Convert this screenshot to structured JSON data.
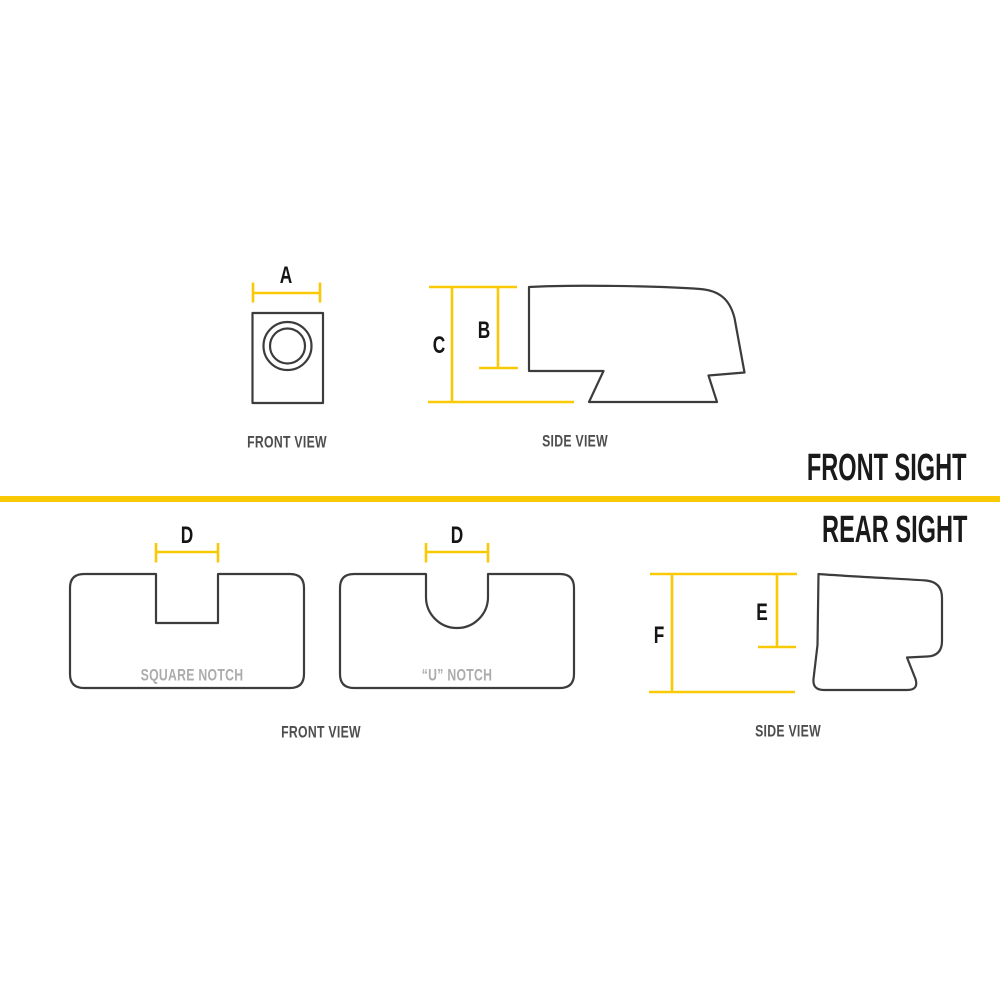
{
  "colors": {
    "accent_yellow": "#F9C906",
    "outline": "#3C3C3C",
    "title_text": "#1A1A1A",
    "caption_text": "#4D4D4D",
    "muted_label": "#ACACAC",
    "background": "#FFFFFF"
  },
  "front_sight": {
    "section_title": "FRONT SIGHT",
    "front_view": {
      "caption": "FRONT VIEW",
      "width_dim_label": "A"
    },
    "side_view": {
      "caption": "SIDE VIEW",
      "blade_height_dim_label": "B",
      "overall_height_dim_label": "C"
    }
  },
  "rear_sight": {
    "section_title": "REAR SIGHT",
    "front_view": {
      "caption": "FRONT VIEW",
      "square_notch_label": "SQUARE NOTCH",
      "square_notch_width_dim_label": "D",
      "u_notch_label": "“U” NOTCH",
      "u_notch_width_dim_label": "D"
    },
    "side_view": {
      "caption": "SIDE VIEW",
      "notch_depth_dim_label": "E",
      "overall_height_dim_label": "F"
    }
  }
}
